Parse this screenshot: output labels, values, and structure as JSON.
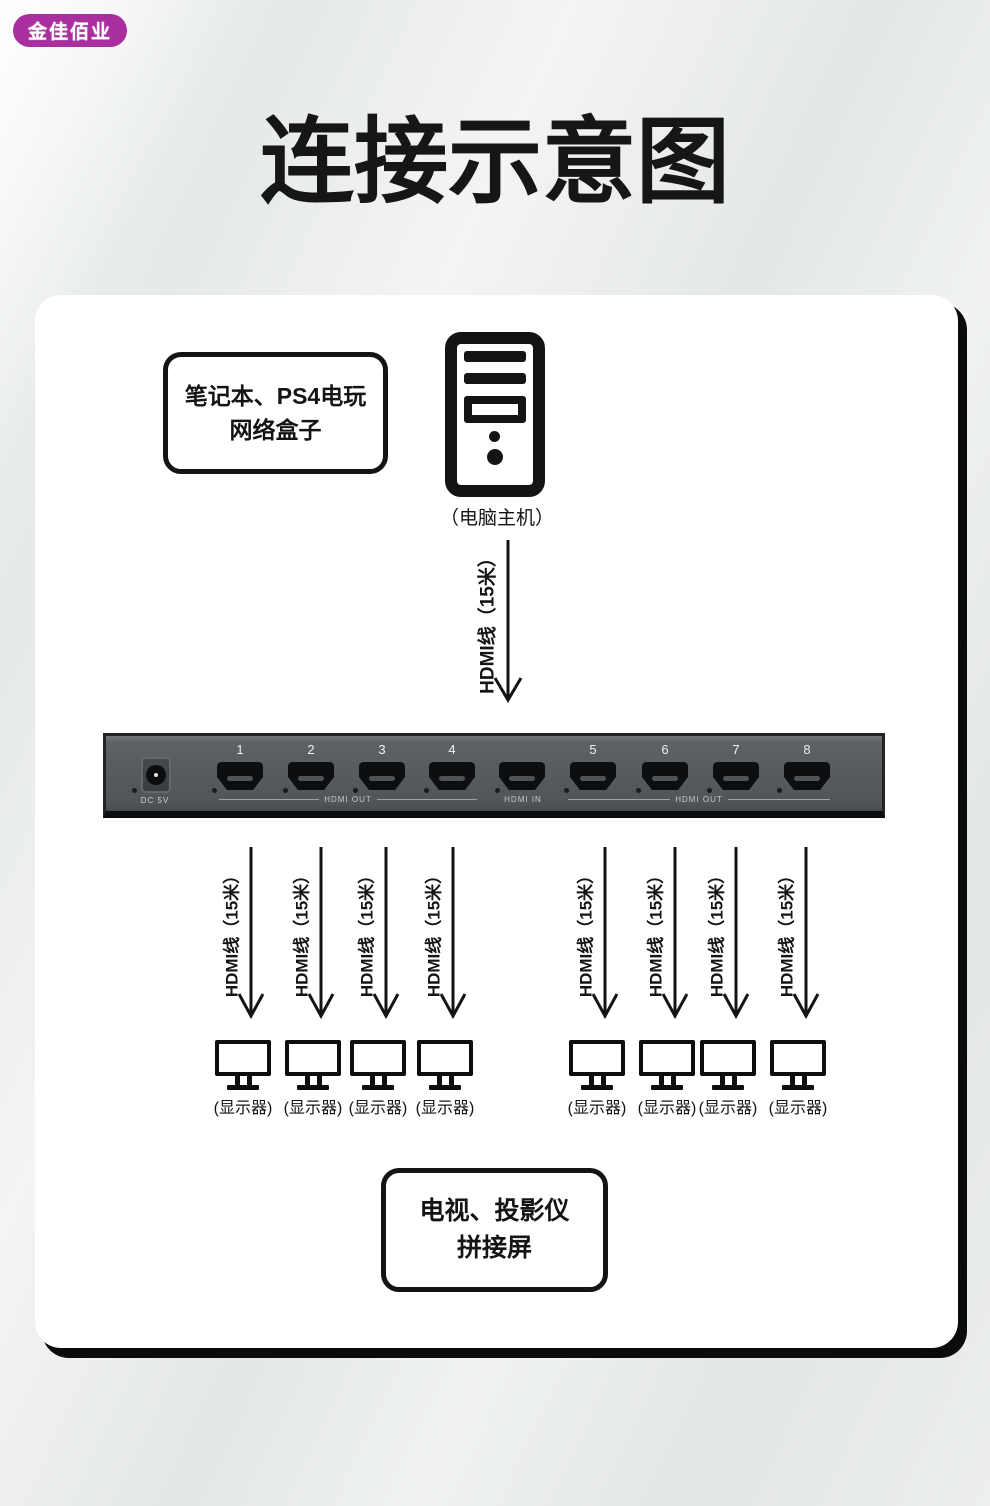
{
  "brand": {
    "label": "金佳佰业"
  },
  "title": "连接示意图",
  "source_box": {
    "line1": "笔记本、PS4电玩",
    "line2": "网络盒子"
  },
  "computer_caption": "（电脑主机）",
  "input_cable": {
    "label": "HDMI线（15米）"
  },
  "device": {
    "power_label": "DC 5V",
    "port_numbers": [
      "1",
      "2",
      "3",
      "4",
      "",
      "5",
      "6",
      "7",
      "8"
    ],
    "hdmi_out_left_label": "HDMI OUT",
    "hdmi_in_label": "HDMI IN",
    "hdmi_out_right_label": "HDMI OUT"
  },
  "output_cables": {
    "label": "HDMI线（15米）"
  },
  "monitor_caption": "(显示器)",
  "sink_box": {
    "line1": "电视、投影仪",
    "line2": "拼接屏"
  },
  "colors": {
    "brand_bg": "#a92f9f",
    "card_bg": "#ffffff",
    "ink": "#141414",
    "panel": "#575a5e",
    "port_black": "#0d0e0f"
  }
}
